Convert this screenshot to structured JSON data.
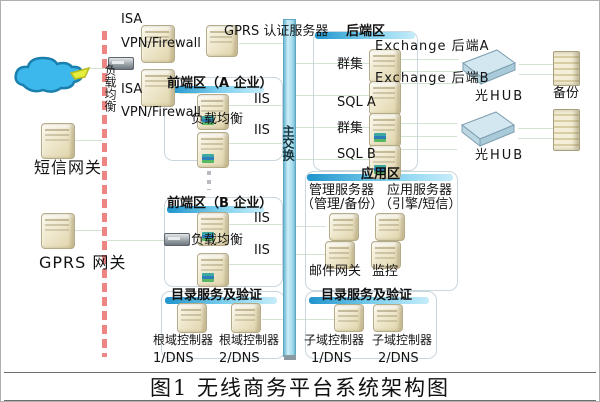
{
  "caption": "图1 无线商务平台系统架构图",
  "left_side": {
    "lb_vertical": "负载均衡",
    "isa_top": {
      "l1": "ISA",
      "l2": "VPN/Firewall"
    },
    "isa_bottom": {
      "l1": "ISA",
      "l2": "VPN/Firewall"
    },
    "sms_gateway": "短信网关",
    "gprs_gateway": "GPRS 网关"
  },
  "top": {
    "gprs_auth": "GPRS 认证服务器"
  },
  "switch": {
    "label": "主交换"
  },
  "zones": {
    "frontend_a": {
      "title": "前端区（A 企业）",
      "lb": "负载均衡",
      "iis1": "IIS",
      "iis2": "IIS"
    },
    "frontend_b": {
      "title": "前端区（B 企业）",
      "lb": "负载均衡",
      "iis1": "IIS",
      "iis2": "IIS"
    },
    "backend": {
      "title": "后端区",
      "cluster1": "群集",
      "sql_a": "SQL A",
      "cluster2": "群集",
      "sql_b": "SQL B",
      "exchange_a": "Exchange 后端A",
      "exchange_b": "Exchange 后端B"
    },
    "application": {
      "title": "应用区",
      "mgmt": "管理服务器",
      "app": "应用服务器",
      "mgmt_sub": "（管理/备份）",
      "app_sub": "（引擎/短信）",
      "mail": "邮件网关",
      "monitor": "监控"
    },
    "directory_root": {
      "title": "目录服务及验证",
      "dc1": "根域控制器",
      "dc2": "根域控制器",
      "dns1": "1/DNS",
      "dns2": "2/DNS"
    },
    "directory_sub": {
      "title": "目录服务及验证",
      "dc1": "子域控制器",
      "dc2": "子域控制器",
      "dns1": "1/DNS",
      "dns2": "2/DNS"
    }
  },
  "right_side": {
    "hub1": "光HUB",
    "hub2": "光HUB",
    "backup": "备份"
  },
  "colors": {
    "zone_bar_start": "#1f94cc",
    "zone_bar_end": "#c6ecfa",
    "switch_fill": "#cdeef8",
    "dashed_line": "#ee8585",
    "connector": "#d4e2d4",
    "cloud": "#3cb8ec"
  }
}
